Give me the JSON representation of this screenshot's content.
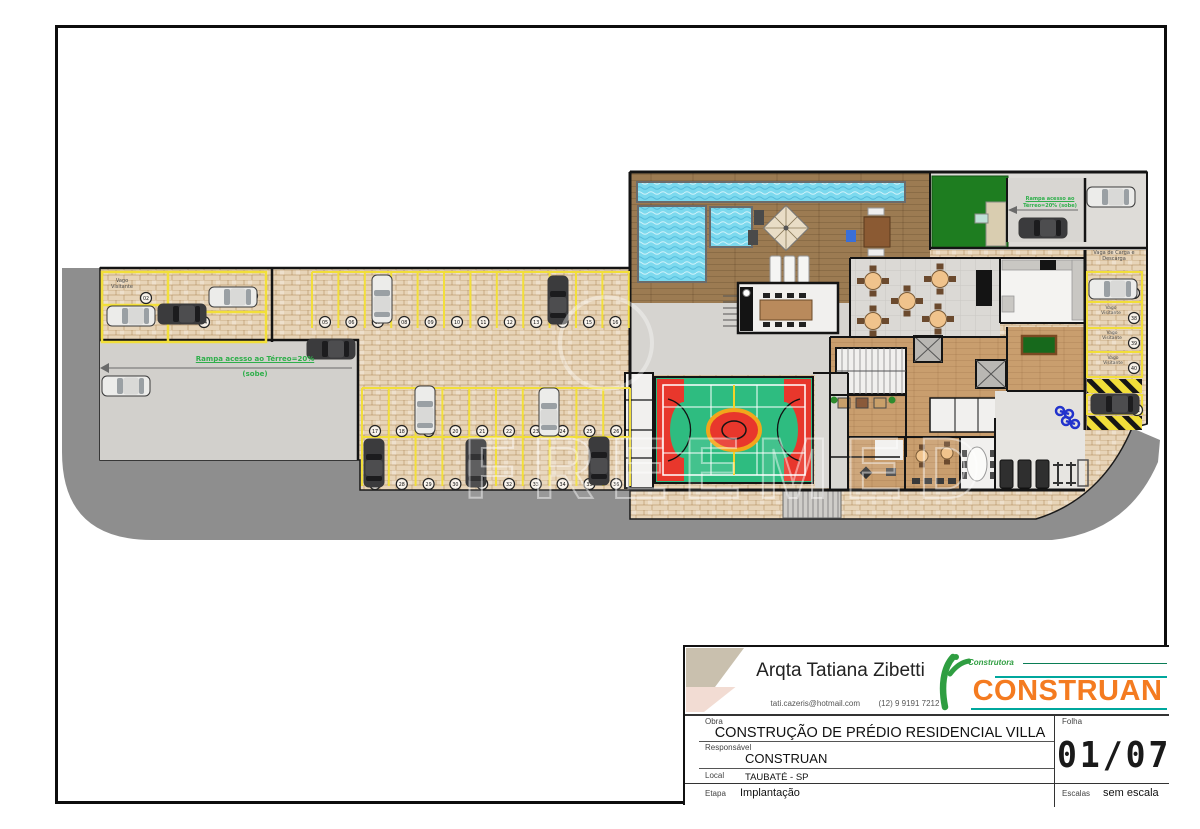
{
  "title_block": {
    "architect": "Arqta Tatiana Zibetti",
    "email": "tati.cazeris@hotmail.com",
    "phone": "(12)  9 9191 7212",
    "logo": {
      "tagline": "Construtora",
      "brand": "CONSTRUAN"
    },
    "fields": {
      "obra_label": "Obra",
      "obra": "CONSTRUÇÃO DE PRÉDIO RESIDENCIAL VILLA",
      "folha_label": "Folha",
      "folha": "01/07",
      "responsavel_label": "Responsável",
      "responsavel": "CONSTRUAN",
      "local_label": "Local",
      "local": "TAUBATÉ - SP",
      "etapa_label": "Etapa",
      "etapa": "Implantação",
      "escalas_label": "Escalas",
      "escalas": "sem escala"
    }
  },
  "plan": {
    "labels": {
      "visitor": "Vago Visitante",
      "loading": "Vaga de Carga e Descarga",
      "ramp_left_1": "Rampa acesso ao Térreo=20%",
      "ramp_left_2": "(sobe)",
      "ramp_right_1": "Rampa acesso ao",
      "ramp_right_2": "Térreo=20% (sobe)",
      "watermark": "FREEMED"
    },
    "colors": {
      "road": "#8e8e8e",
      "brick": "#e7d4b8",
      "water": "#7cd9ee",
      "lawn": "#1e7d20",
      "court_green": "#2ebc80",
      "court_red": "#e8372c",
      "stall_yellow": "#f2df3a"
    },
    "parking_rows": [
      {
        "y": 322,
        "x0": 325,
        "dx": 26.4,
        "count": 12,
        "start": 5
      },
      {
        "y": 431,
        "x0": 375,
        "dx": 26.8,
        "count": 10,
        "start": 17
      },
      {
        "y": 484,
        "x0": 375,
        "dx": 26.8,
        "count": 10,
        "start": 27
      }
    ],
    "extra_spots": [
      [
        146,
        298,
        "02"
      ],
      [
        252,
        296,
        "03"
      ],
      [
        204,
        322,
        "04"
      ],
      [
        1134,
        293,
        "37"
      ],
      [
        1134,
        318,
        "38"
      ],
      [
        1134,
        343,
        "39"
      ],
      [
        1134,
        368,
        "40"
      ],
      [
        1137,
        410,
        "41"
      ]
    ],
    "yellow_rows": [
      {
        "x0": 312,
        "dx": 26.4,
        "n": 13,
        "y1": 272,
        "y2": 328
      },
      {
        "x0": 362,
        "dx": 26.8,
        "n": 11,
        "y1": 388,
        "y2": 486
      }
    ],
    "cars": [
      [
        131,
        316,
        0,
        "white"
      ],
      [
        182,
        314,
        0,
        "dark"
      ],
      [
        233,
        297,
        0,
        "white"
      ],
      [
        126,
        386,
        0,
        "white"
      ],
      [
        331,
        349,
        0,
        "dark"
      ],
      [
        382,
        299,
        90,
        "white"
      ],
      [
        558,
        300,
        90,
        "dark"
      ],
      [
        425,
        410,
        90,
        "white"
      ],
      [
        549,
        412,
        90,
        "white"
      ],
      [
        374,
        463,
        90,
        "dark"
      ],
      [
        476,
        463,
        90,
        "dark"
      ],
      [
        599,
        461,
        90,
        "dark"
      ],
      [
        1043,
        228,
        0,
        "dark"
      ],
      [
        1111,
        197,
        0,
        "white"
      ],
      [
        1113,
        289,
        0,
        "white"
      ],
      [
        1115,
        404,
        0,
        "dark"
      ]
    ],
    "car_colors": {
      "white": {
        "body": "#ececea",
        "glass": "#9aa0a4",
        "roof": "#d9d9d7"
      },
      "dark": {
        "body": "#3b3b3d",
        "glass": "#1c1c1e",
        "roof": "#4d4d4f"
      }
    },
    "round_tables": [
      [
        873,
        281
      ],
      [
        940,
        279
      ],
      [
        907,
        301
      ],
      [
        873,
        321
      ],
      [
        938,
        319
      ]
    ],
    "small_tables": [
      [
        922,
        456
      ],
      [
        947,
        453
      ]
    ]
  }
}
